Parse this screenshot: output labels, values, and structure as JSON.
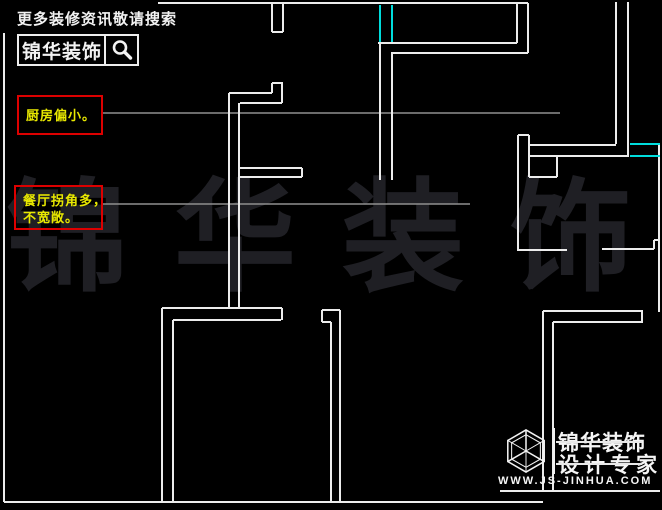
{
  "branding_top": {
    "search_hint": "更多装修资讯敬请搜索",
    "brand_name": "锦华装饰",
    "search_icon": "magnifier-icon"
  },
  "annotations": [
    {
      "lines": [
        "厨房偏小。"
      ]
    },
    {
      "lines": [
        "餐厅拐角多，",
        "不宽敞。"
      ]
    }
  ],
  "watermark_text": "锦华装饰",
  "branding_bottom": {
    "logo_icon": "cube-wireframe-icon",
    "brand_name": "锦华装饰",
    "tagline": "设计专家",
    "website": "WWW.JS-JINHUA.COM"
  },
  "colors": {
    "background": "#000000",
    "wall": "#ececec",
    "wall_dim": "#b9b9b9",
    "window": "#00dcdc",
    "leader": "#8f8f8f",
    "annotation_border": "#dd0000",
    "annotation_text": "#e8e800",
    "watermark": "#1f1f24",
    "branding": "#f2f2f2"
  },
  "floorplan": {
    "walls": [
      [
        158,
        3,
        528,
        3
      ],
      [
        272,
        3,
        272,
        32
      ],
      [
        283,
        3,
        283,
        32
      ],
      [
        272,
        32,
        283,
        32
      ],
      [
        517,
        3,
        517,
        43
      ],
      [
        528,
        3,
        528,
        53
      ],
      [
        378,
        43,
        517,
        43
      ],
      [
        391,
        53,
        528,
        53
      ],
      [
        380,
        43,
        380,
        180
      ],
      [
        392,
        53,
        392,
        180
      ],
      [
        229,
        93,
        229,
        308
      ],
      [
        229,
        93,
        272,
        93
      ],
      [
        272,
        83,
        272,
        93
      ],
      [
        272,
        83,
        283,
        83
      ],
      [
        282,
        83,
        282,
        103
      ],
      [
        240,
        103,
        282,
        103
      ],
      [
        239,
        103,
        239,
        308
      ],
      [
        239,
        168,
        302,
        168
      ],
      [
        302,
        168,
        302,
        177
      ],
      [
        240,
        177,
        302,
        177
      ],
      [
        162,
        308,
        282,
        308
      ],
      [
        282,
        308,
        282,
        320
      ],
      [
        173,
        320,
        281,
        320
      ],
      [
        162,
        308,
        162,
        502
      ],
      [
        173,
        320,
        173,
        502
      ],
      [
        4,
        33,
        4,
        502
      ],
      [
        4,
        502,
        543,
        502
      ],
      [
        322,
        310,
        340,
        310
      ],
      [
        322,
        310,
        322,
        322
      ],
      [
        322,
        322,
        331,
        322
      ],
      [
        331,
        322,
        331,
        502
      ],
      [
        340,
        310,
        340,
        502
      ],
      [
        518,
        135,
        518,
        251
      ],
      [
        518,
        135,
        529,
        135
      ],
      [
        529,
        135,
        529,
        177
      ],
      [
        529,
        145,
        616,
        145
      ],
      [
        529,
        156,
        627,
        156
      ],
      [
        557,
        156,
        557,
        177
      ],
      [
        529,
        177,
        557,
        177
      ],
      [
        616,
        2,
        616,
        144
      ],
      [
        628,
        2,
        628,
        157
      ],
      [
        518,
        250,
        567,
        250
      ],
      [
        602,
        249,
        654,
        249
      ],
      [
        654,
        240,
        654,
        249
      ],
      [
        654,
        240,
        660,
        240
      ],
      [
        659,
        144,
        659,
        312
      ],
      [
        543,
        311,
        643,
        311
      ],
      [
        553,
        322,
        643,
        322
      ],
      [
        642,
        311,
        642,
        322
      ],
      [
        543,
        311,
        543,
        491
      ],
      [
        553,
        322,
        553,
        491
      ],
      [
        500,
        491,
        660,
        491
      ]
    ],
    "windows": [
      [
        380,
        5,
        380,
        42
      ],
      [
        392,
        5,
        392,
        42
      ],
      [
        630,
        144,
        660,
        144
      ],
      [
        630,
        156,
        660,
        156
      ]
    ],
    "leaders": [
      [
        103,
        113,
        560,
        113
      ],
      [
        103,
        204,
        470,
        204
      ]
    ]
  }
}
